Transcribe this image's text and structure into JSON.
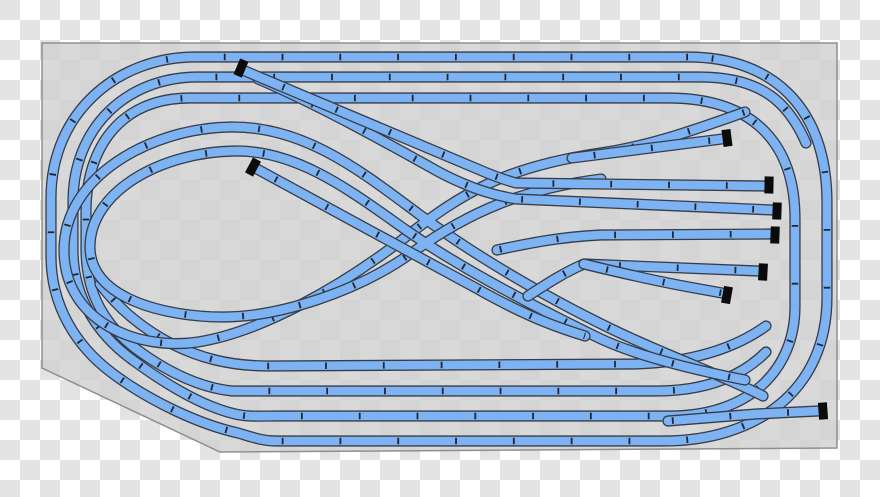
{
  "canvas": {
    "width": 880,
    "height": 497
  },
  "background": {
    "checker_light": "#ffffff",
    "checker_dark": "#e3e3e3",
    "square_px": 20
  },
  "board": {
    "points": "42,43 837,43 837,448 220,452 42,368",
    "fill": "rgba(209,209,209,0.82)",
    "stroke": "#8f8f8f",
    "stroke_width": 1.5
  },
  "track_style": {
    "fill_color": "#7db3f2",
    "outline_color": "#363d49",
    "tick_color": "#1f2735",
    "outline_width": 11.2,
    "fill_width": 8.6,
    "tick_width": 6.5,
    "tick_dash": "1.8 56"
  },
  "buffer_style": {
    "color": "#0b0b0b",
    "length_along_track": 9,
    "width_across_track": 17
  },
  "tracks": [
    {
      "name": "outer-oval-loop",
      "d": "M 688 57 L 195 57 C 118 57 51 112 51 198 L 51 256 C 51 306 76 346 112 373 C 152 403 202 425 238 433 C 252 437 262 441 276 441 L 663 441 C 756 441 827 391 827 297 L 827 203 C 827 107 772 57 688 57 Z"
    },
    {
      "name": "second-loop-inner-oval",
      "d": "M 806 143 C 789 104 763 77 700 77 L 198 77 C 126 77 73 128 73 202 L 73 250 C 73 299 99 336 134 361 C 171 388 205 407 235 414 C 248 417 260 416 276 416 L 670 416 C 748 416 795 371 795 306 L 795 219 C 795 147 757 98 668 98 L 190 98 C 121 98 86 147 86 212 L 86 249 C 86 295 106 327 139 351 C 172 375 204 388 232 391 L 656 391 C 705 391 741 377 766 352"
    },
    {
      "name": "bottom-inner-track",
      "d": "M 100 284 C 118 308 143 329 172 344 C 198 357 228 366 268 366 L 636 364 C 692 362 734 349 766 326"
    },
    {
      "name": "figure-eight-outer",
      "d": "M 745 112 C 700 128 650 146 600 153 C 505 167 462 193 407 236 C 344 285 262 332 198 342 C 138 351 64 322 64 250 C 64 177 150 128 231 127 C 305 126 362 172 420 215 C 478 258 556 303 622 334 C 676 359 726 377 763 396"
    },
    {
      "name": "figure-eight-inner",
      "d": "M 601 179 C 522 189 469 212 413 252 C 356 293 277 317 223 317 C 166 317 90 299 90 247 C 90 192 160 152 235 151 C 298 150 352 192 406 230 C 460 268 539 309 601 339 C 640 357 700 371 745 380"
    },
    {
      "name": "middle-stub-spur",
      "d": "M 257 169 L 474 287 C 497 300 520 312 545 322 C 560 328 572 332 585 336"
    },
    {
      "name": "crossover-branch-to-siding-3",
      "d": "M 258 79 C 315 103 385 142 430 167 C 442 174 450 178 462 183 C 480 191 498 196 516 199 L 772 210"
    },
    {
      "name": "upper-stub-spur-to-siding-2",
      "d": "M 245 71 L 487 173 C 497 177 505 180 516 183 L 764 186"
    },
    {
      "name": "yard-siding-1",
      "d": "M 572 158 L 722 139"
    },
    {
      "name": "yard-siding-4",
      "d": "M 497 250 C 530 243 560 237 600 235 L 770 234"
    },
    {
      "name": "yard-siding-5",
      "d": "M 528 296 C 548 283 565 272 584 264 L 758 271"
    },
    {
      "name": "yard-siding-6",
      "d": "M 584 264 C 625 274 665 283 700 289 L 722 293"
    },
    {
      "name": "bottom-right-spur",
      "d": "M 668 421 C 705 418 732 416 756 414 L 818 411"
    }
  ],
  "buffers": [
    {
      "name": "buffer-top-center",
      "x": 241,
      "y": 68,
      "angle": 23
    },
    {
      "name": "buffer-left-middle",
      "x": 253,
      "y": 167,
      "angle": 28
    },
    {
      "name": "buffer-siding-1",
      "x": 727,
      "y": 138,
      "angle": -7
    },
    {
      "name": "buffer-siding-2",
      "x": 769,
      "y": 185,
      "angle": 1
    },
    {
      "name": "buffer-siding-3",
      "x": 777,
      "y": 211,
      "angle": 2
    },
    {
      "name": "buffer-siding-4",
      "x": 775,
      "y": 235,
      "angle": 2
    },
    {
      "name": "buffer-siding-5",
      "x": 763,
      "y": 272,
      "angle": 3
    },
    {
      "name": "buffer-siding-6",
      "x": 727,
      "y": 295,
      "angle": 10
    },
    {
      "name": "buffer-bottom-right",
      "x": 823,
      "y": 411,
      "angle": -4
    }
  ]
}
